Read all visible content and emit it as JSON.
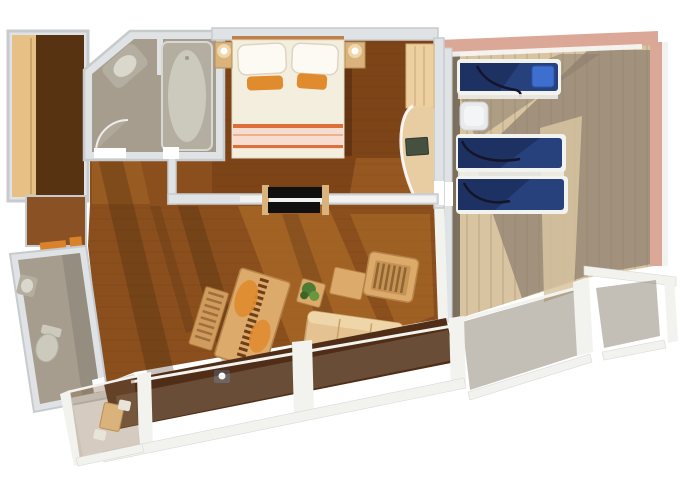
{
  "meta": {
    "title": "Cruise ship suite floor plan rendering",
    "view": "top-down 3D floor plan",
    "visible_text": ""
  },
  "plan": {
    "rooms": [
      {
        "name": "entry-hall",
        "furniture": [
          "wardrobe"
        ]
      },
      {
        "name": "bathroom",
        "furniture": [
          "bathtub",
          "corner-sink",
          "door-swing"
        ]
      },
      {
        "name": "powder-room",
        "furniture": [
          "toilet",
          "small-sink"
        ]
      },
      {
        "name": "bedroom",
        "furniture": [
          "double-bed",
          "pillows",
          "nightstand-left",
          "nightstand-right",
          "bedside-lamps",
          "closet",
          "curved-vanity",
          "tv-screen",
          "sliding-double-door"
        ]
      },
      {
        "name": "living-room",
        "furniture": [
          "dining-table",
          "slatted-bench",
          "armchair",
          "coffee-table",
          "sofa",
          "side-table",
          "potted-plant"
        ]
      },
      {
        "name": "balcony",
        "furniture": [
          "glass-railing",
          "railing-posts",
          "corner-cafe-table",
          "deck-chair",
          "step-light"
        ]
      },
      {
        "name": "private-veranda",
        "furniture": [
          "sun-lounger-1",
          "sun-lounger-2",
          "sun-lounger-3",
          "white-side-table",
          "glass-railing",
          "windbreak-walls"
        ]
      }
    ]
  },
  "colors": {
    "bg": "#ffffff",
    "wall_fill": "#e0e3e5",
    "wall_stroke": "#c7cbce",
    "wall_highlight": "#f8f8f6",
    "bathroom_floor": "#a69d8e",
    "fixture_gray": "#b3aea0",
    "fixture_light": "#ccc9bd",
    "floor_living": "#8a4f1d",
    "floor_living_light": "#b9762c",
    "floor_living_shadow": "#42250e",
    "floor_bedroom": "#7d4418",
    "floor_bedroom_light": "#9a5c22",
    "floor_hall_dark": "#583312",
    "floor_corridor": "#8a5224",
    "wood_wardrobe": "#e6c084",
    "bed_white": "#f4eede",
    "pillow_white": "#fcfaf2",
    "accent_orange": "#e08b2d",
    "stripe_orange": "#dd6f3a",
    "stripe_pink": "#f7ddd0",
    "headboard": "#c08048",
    "nightstand": "#d9b27c",
    "closet_wood": "#ecd0a0",
    "vanity_wood": "#e9cda2",
    "tv_screen": "#45503f",
    "door_black": "#101010",
    "door_cap": "#d9b27c",
    "furn_wood": "#dcaa6a",
    "furn_wood_dark": "#b5834a",
    "sofa": "#e5c292",
    "sofa_line": "#c9a06a",
    "plant_green": "#4e7c34",
    "plant_green_light": "#69973f",
    "deck_floor": "#d8c4a0",
    "deck_shadow": "#8b7d6d",
    "deck_dark_strip": "#6d6154",
    "deck_wall_salmon": "#dba898",
    "lounger_navy": "#26417b",
    "lounger_navy_dark": "#1d3262",
    "towel_blue": "#3e6fce",
    "cable_dark": "#14142a",
    "rail_white": "#f2f2ee",
    "balcony_floor": "#4f2d16",
    "threshold_orange": "#d9822b",
    "table_white": "#e9eaec"
  }
}
